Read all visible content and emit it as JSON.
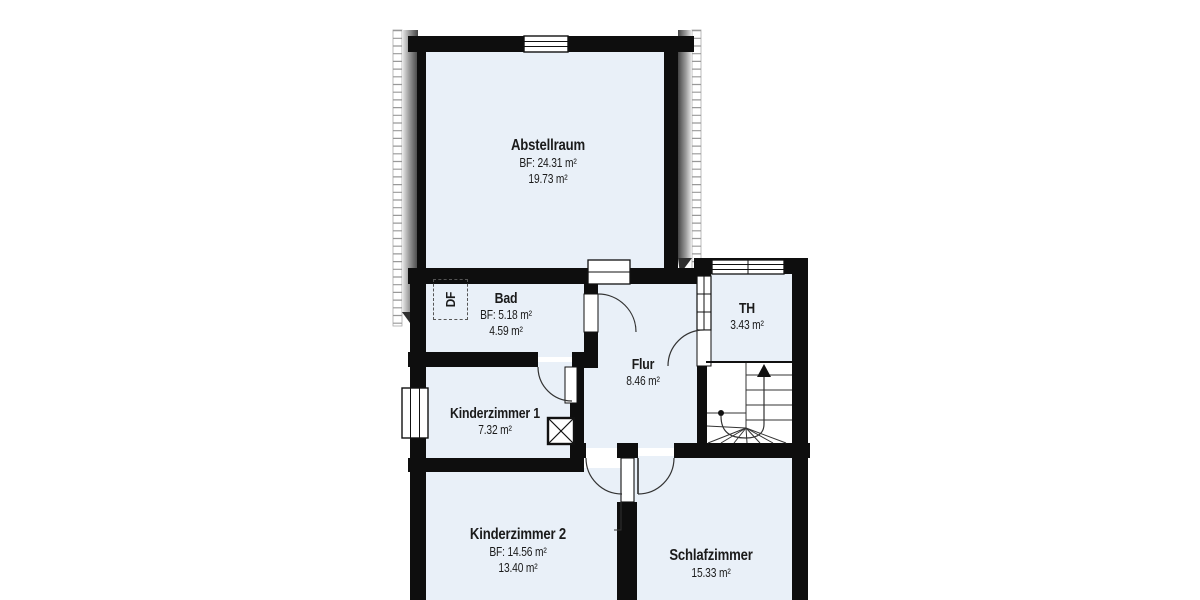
{
  "plan_title": "Dachgeschoss Grundriss",
  "colors": {
    "wall": "#0e0e0e",
    "room_fill": "#e9f0f8",
    "stair_fill": "#ffffff",
    "line": "#333333",
    "text": "#1b1b1b"
  },
  "rooms": {
    "abstellraum": {
      "name": "Abstellraum",
      "line1": "BF: 24.31 m²",
      "line2": "19.73 m²"
    },
    "bad": {
      "name": "Bad",
      "line1": "BF: 5.18 m²",
      "line2": "4.59 m²"
    },
    "th": {
      "name": "TH",
      "line1": "3.43 m²"
    },
    "flur": {
      "name": "Flur",
      "line1": "8.46 m²"
    },
    "kinderzimmer1": {
      "name": "Kinderzimmer 1",
      "line1": "7.32 m²"
    },
    "kinderzimmer2": {
      "name": "Kinderzimmer 2",
      "line1": "BF: 14.56 m²",
      "line2": "13.40 m²"
    },
    "schlafzimmer": {
      "name": "Schlafzimmer",
      "line1": "15.33 m²"
    }
  },
  "annotations": {
    "roof_window_label": "DF"
  }
}
